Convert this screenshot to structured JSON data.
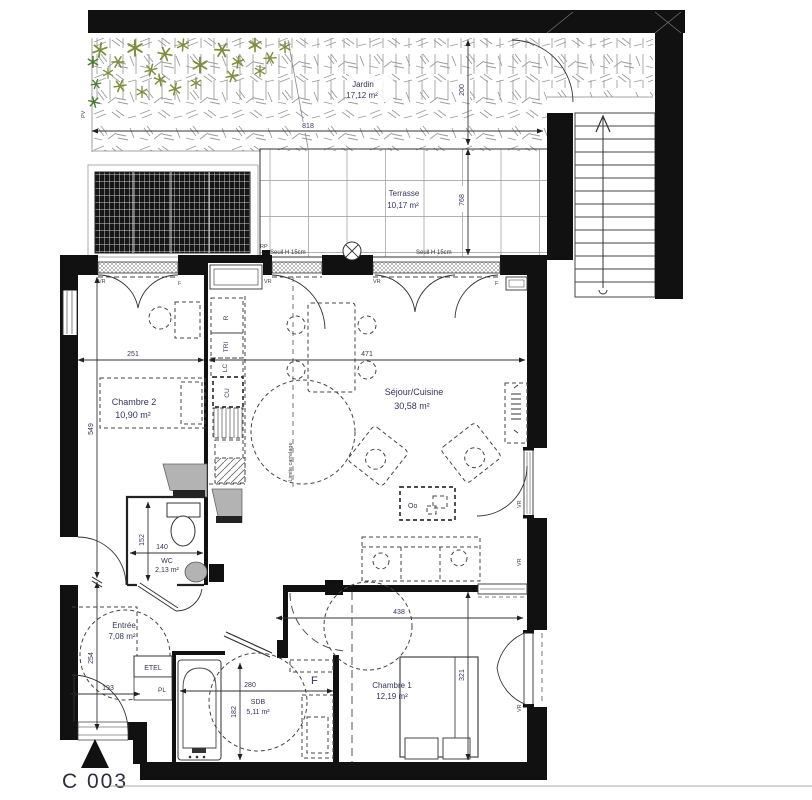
{
  "unit": {
    "label": "C 003"
  },
  "rooms": [
    {
      "name": "Jardin",
      "area": "17,12 m²"
    },
    {
      "name": "Terrasse",
      "area": "10,17 m²"
    },
    {
      "name": "Séjour/Cuisine",
      "area": "30,58 m²"
    },
    {
      "name": "Chambre 2",
      "area": "10,90 m²"
    },
    {
      "name": "WC",
      "area": "2,13 m²"
    },
    {
      "name": "Entrée",
      "area": "7,08 m²"
    },
    {
      "name": "SDB",
      "area": "5,11 m²"
    },
    {
      "name": "Chambre 1",
      "area": "12,19 m²"
    }
  ],
  "dimensions_cm": {
    "garden_width": "818",
    "garden_depth": "200",
    "terrace_depth": "768",
    "chambre2_width": "251",
    "chambre2_height": "549",
    "sejour_width": "471",
    "wc_width": "140",
    "wc_height": "152",
    "entree_width": "193",
    "entree_height": "254",
    "sdb_width": "280",
    "sdb_height": "182",
    "chambre1_width": "438",
    "chambre1_height": "321"
  },
  "labels": {
    "seuil": "Seuil H 15cm",
    "rp": "RP",
    "pv": "PV",
    "vr": "VR",
    "f": "F",
    "etel": "ETEL",
    "pl": "PL",
    "limite_carrelage": "Limite carrelage",
    "table_symbol": "Oo"
  },
  "kitchen": {
    "fridge": "R",
    "sorting": "TRI",
    "lc": "LC",
    "cooking": "CU"
  },
  "colors": {
    "wall": "#111111",
    "hatch_gray": "#9b9b9b",
    "label_text": "#35355a",
    "plant_green": "#7d8f3a",
    "plant_dark_green": "#4a7a30",
    "limite_text": "#8f8f62"
  }
}
